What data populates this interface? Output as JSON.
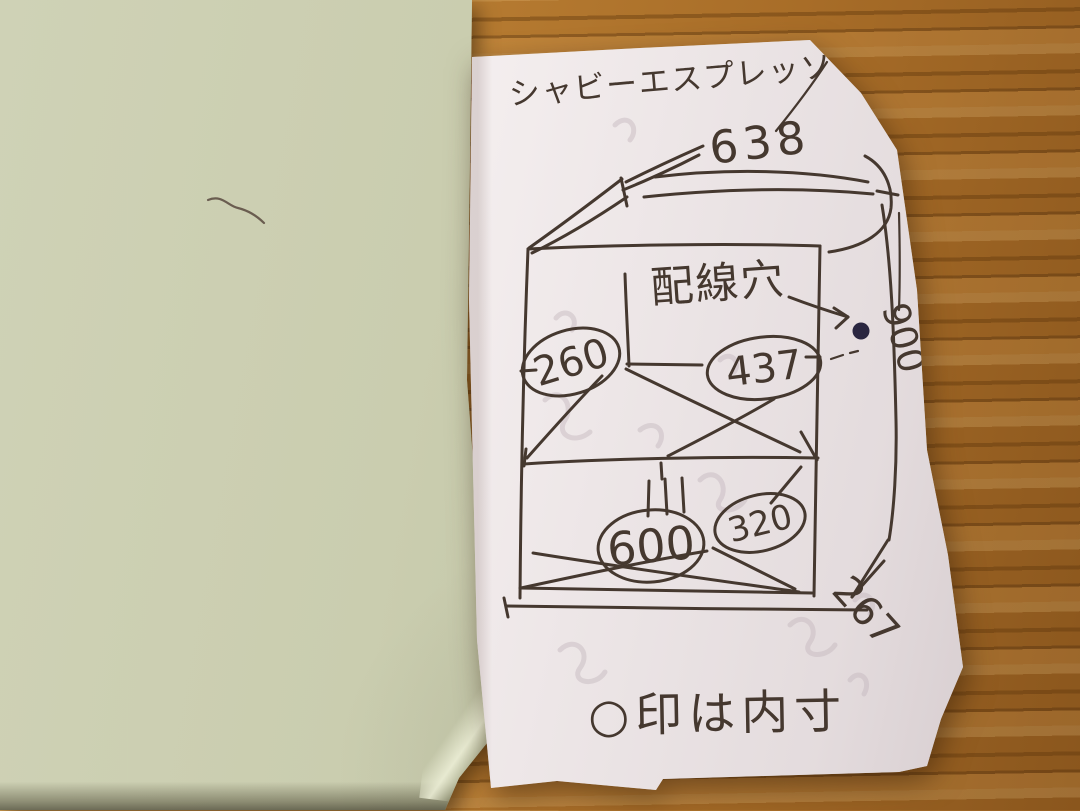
{
  "note": {
    "title": "シャビーエスプレッソ",
    "dimensions": {
      "top_width": "638",
      "upper_left_inner": "260",
      "upper_right_inner": "437",
      "height": "900",
      "lower_inner_width": "600",
      "lower_right_inner": "320",
      "depth": "267"
    },
    "labels": {
      "wiring_hole": "配線穴",
      "legend": "○印は内寸"
    }
  },
  "colors": {
    "ink": "#45382f",
    "ink_faint": "#c3b6bc",
    "ink_dot": "#2a2640",
    "paper_white": "#f2ecec",
    "paper_green": "#c5c8aa",
    "wood_base": "#ae7730"
  }
}
